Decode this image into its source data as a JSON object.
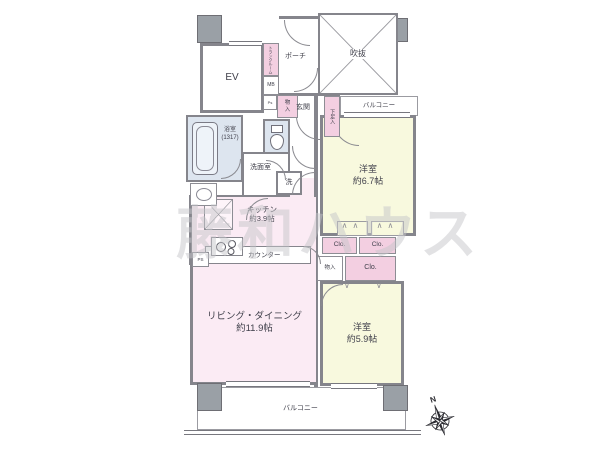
{
  "watermark": "藤和ハウス",
  "compass": {
    "north_label": "N"
  },
  "symbols": {
    "closet_peaks": "∧∧",
    "closet_v": "∨",
    "closet_v2": "∨"
  },
  "colors": {
    "room_pink": "#fbebf4",
    "closet_pink": "#f3cfe1",
    "room_yellow": "#f8f9de",
    "wet_area_blue": "#dde5ef",
    "wall_gray": "#85858c",
    "pillar_gray": "#9aa0a6",
    "watermark_gray": "#c6c6ca"
  },
  "rooms": {
    "ev": {
      "label": "EV"
    },
    "trunk": {
      "label": "トランクルーム"
    },
    "mb": {
      "label": "MB"
    },
    "ps_upper": {
      "label": "Ps"
    },
    "storage_entry": {
      "label": "物入"
    },
    "porch": {
      "label": "ポーチ"
    },
    "void": {
      "label": "吹抜"
    },
    "entrance": {
      "label": "玄関"
    },
    "shoe_box": {
      "label": "下足入"
    },
    "balcony_upper": {
      "label": "バルコニー"
    },
    "bedroom_67": {
      "name": "洋室",
      "size": "約6.7帖"
    },
    "bathroom": {
      "name": "浴室",
      "size": "(1317)"
    },
    "washroom": {
      "label": "洗面室"
    },
    "washer": {
      "label": "洗"
    },
    "fridge": {
      "label": "冷"
    },
    "kitchen": {
      "name": "キッチン",
      "size": "約3.9帖"
    },
    "counter": {
      "label": "カウンター"
    },
    "ps_kitchen": {
      "label": "PS"
    },
    "living_dining": {
      "name": "リビング・ダイニング",
      "size": "約11.9帖"
    },
    "closet_a": {
      "label": "Clo."
    },
    "closet_b": {
      "label": "Clo."
    },
    "storage_mid": {
      "label": "物入"
    },
    "closet_c": {
      "label": "Clo."
    },
    "bedroom_59": {
      "name": "洋室",
      "size": "約5.9帖"
    },
    "balcony_lower": {
      "label": "バルコニー"
    }
  }
}
